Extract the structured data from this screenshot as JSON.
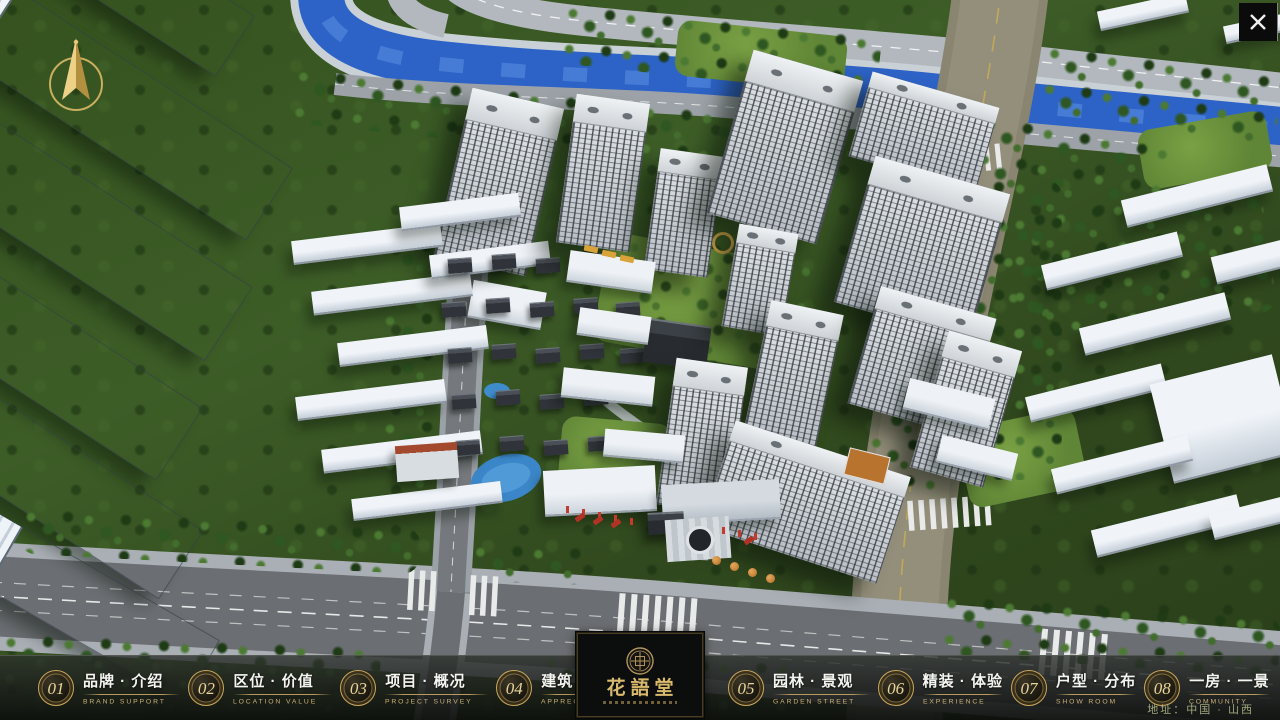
{
  "navbar": {
    "items": [
      {
        "number": "01",
        "label": "品牌 · 介绍",
        "sub": "BRAND SUPPORT"
      },
      {
        "number": "02",
        "label": "区位 · 价值",
        "sub": "LOCATION VALUE"
      },
      {
        "number": "03",
        "label": "项目 · 概况",
        "sub": "PROJECT SURVEY"
      },
      {
        "number": "04",
        "label": "建筑 · 鉴赏",
        "sub": "APPRECIATION"
      },
      {
        "number": "05",
        "label": "园林 · 景观",
        "sub": "GARDEN STREET"
      },
      {
        "number": "06",
        "label": "精装 · 体验",
        "sub": "EXPERIENCE"
      },
      {
        "number": "07",
        "label": "户型 · 分布",
        "sub": "SHOW ROOM"
      },
      {
        "number": "08",
        "label": "一房 · 一景",
        "sub": "COMMUNITY"
      }
    ]
  },
  "logo": {
    "title": "花語堂"
  },
  "footer": {
    "address": "地址：中国 · 山西"
  },
  "colors": {
    "accent_gold": "#c9a85f",
    "river_blue": "#2d63c6",
    "road_tan": "#948f7b",
    "tree_green": "#2f5722",
    "navbar_bg": "#141614"
  }
}
